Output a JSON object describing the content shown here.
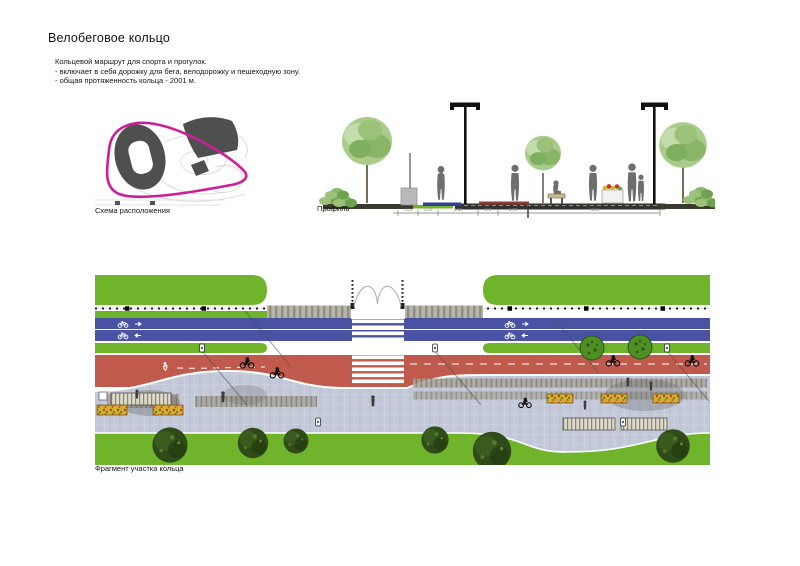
{
  "page": {
    "title": "Велобеговое кольцо",
    "description_lines": [
      "Кольцевой маршрут для спорта и прогулок.",
      "- включает в себя дорожку для бега, велодорожку и пешеходную зону.",
      "- общая протяженность кольца - 2001 м."
    ]
  },
  "scheme": {
    "caption": "Схема расположения",
    "route_color": "#cc1f97"
  },
  "profile": {
    "caption": "Профиль",
    "dimension_labels": [
      "1.00",
      "1.50",
      "3.50",
      "0.5",
      "2.00",
      "12.0"
    ]
  },
  "plan": {
    "caption": "Фрагмент участка кольца",
    "colors": {
      "grass": "#6fb42a",
      "bike_lane": "#4a52a4",
      "running_track": "#c05a4d",
      "pedestrian_zone": "#c2c8d7"
    }
  }
}
